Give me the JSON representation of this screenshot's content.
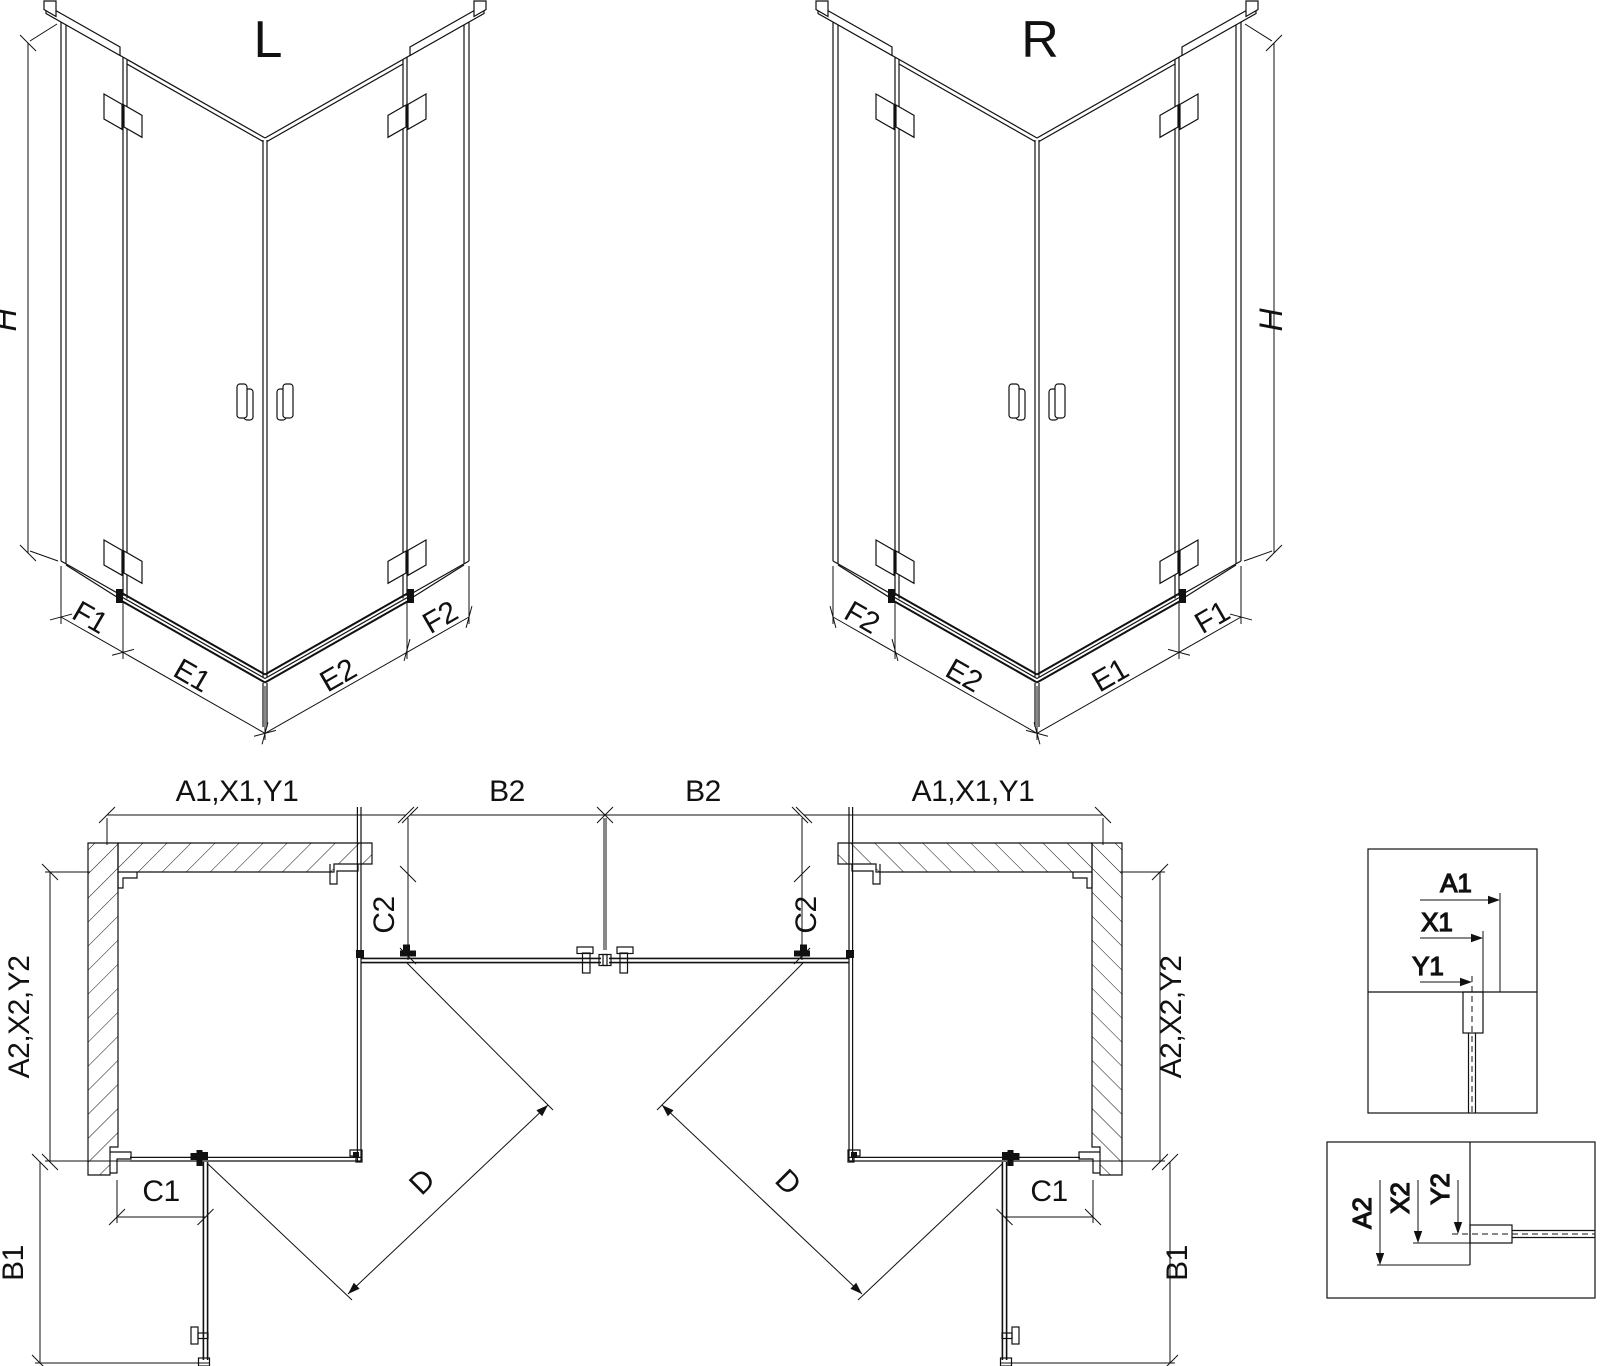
{
  "colors": {
    "line": "#111111",
    "background": "#ffffff"
  },
  "iso_left": {
    "variant_label": "L",
    "height_dim": "H",
    "bottom_dims": [
      "F1",
      "E1",
      "E2",
      "F2"
    ]
  },
  "iso_right": {
    "variant_label": "R",
    "height_dim": "H",
    "bottom_dims": [
      "F2",
      "E2",
      "E1",
      "F1"
    ]
  },
  "plan_left": {
    "width_dim": "A1,X1,Y1",
    "open_door_top_dim": "B2",
    "fixed_panel_top_dim": "C2",
    "depth_dim": "A2,X2,Y2",
    "fixed_panel_side_dim": "C1",
    "open_door_side_dim": "B1",
    "diagonal_dim": "D"
  },
  "plan_right": {
    "width_dim": "A1,X1,Y1",
    "open_door_top_dim": "B2",
    "fixed_panel_top_dim": "C2",
    "depth_dim": "A2,X2,Y2",
    "fixed_panel_side_dim": "C1",
    "open_door_side_dim": "B1",
    "diagonal_dim": "D"
  },
  "detail_top": {
    "dims": [
      "A1",
      "X1",
      "Y1"
    ]
  },
  "detail_bottom": {
    "dims": [
      "A2",
      "X2",
      "Y2"
    ]
  }
}
